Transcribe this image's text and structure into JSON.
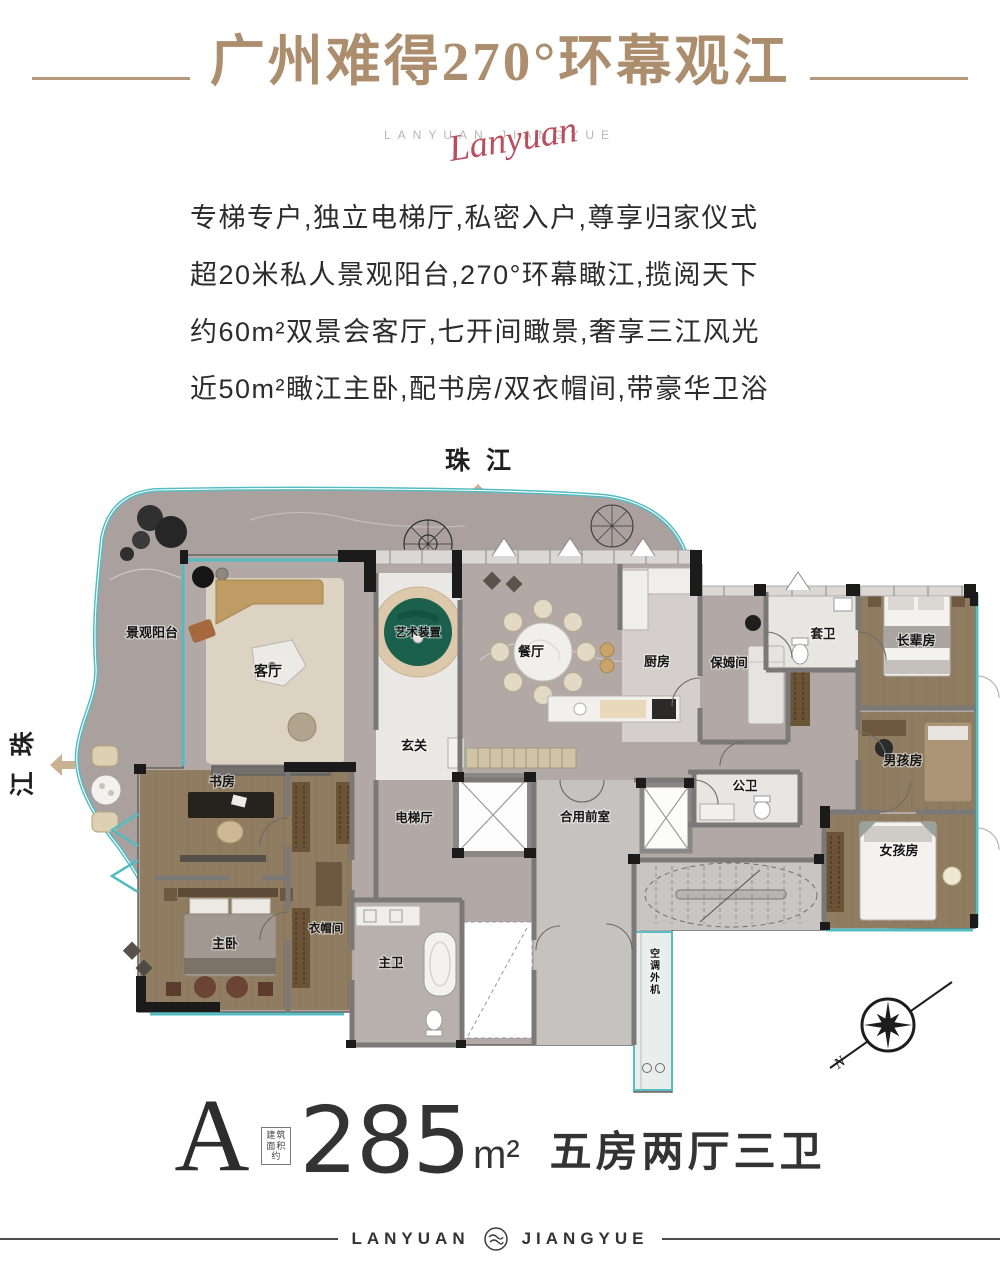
{
  "title": {
    "text": "广州难得270°环幕观江"
  },
  "logo": {
    "latin": "LANYUAN JIANGYUE",
    "script": "Lanyuan"
  },
  "intro": {
    "lines": [
      "专梯专户,独立电梯厅,私密入户,尊享归家仪式",
      "超20米私人景观阳台,270°环幕瞰江,揽阅天下",
      "约60m²双景会客厅,七开间瞰景,奢享三江风光",
      "近50m²瞰江主卧,配书房/双衣帽间,带豪华卫浴"
    ]
  },
  "river": {
    "top": "珠江",
    "left_chars": [
      "珠",
      "江"
    ]
  },
  "rooms": {
    "balcony": "景观阳台",
    "living": "客厅",
    "art": "艺术装置",
    "foyer": "玄关",
    "dining": "餐厅",
    "kitchen": "厨房",
    "nanny": "保姆间",
    "ensuite_bath": "套卫",
    "elder": "长辈房",
    "boy": "男孩房",
    "girl": "女孩房",
    "public_bath": "公卫",
    "shared_lobby": "合用前室",
    "elevator_hall": "电梯厅",
    "study": "书房",
    "master": "主卧",
    "cloakroom": "衣帽间",
    "master_bath": "主卫",
    "ac_unit": "空调外机"
  },
  "compass": {
    "north": "N"
  },
  "spec": {
    "unit": "A",
    "area_prefix": "建筑面积约",
    "area": "285",
    "area_unit": "m²",
    "layout": "五房两厅三卫"
  },
  "footer": {
    "left": "LANYUAN",
    "right": "JIANGYUE"
  },
  "colors": {
    "gold": "#ac8e6e",
    "crimson": "#b94f5e",
    "teal": "#53bcc2",
    "green": "#1a604c"
  }
}
